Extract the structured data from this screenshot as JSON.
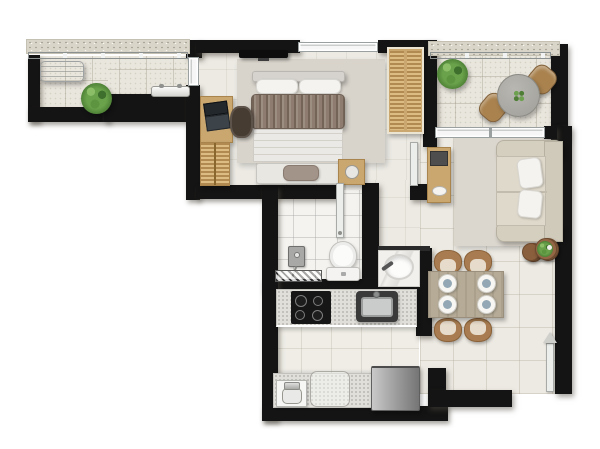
{
  "title": "Furnished one-bedroom apartment floor plan, top-down view, no text labels",
  "palette": {
    "wall": "#141414",
    "floor_tile": "#edeae3",
    "balcony_tile": "#e9e6dd",
    "bathroom_tile": "#f4f3ef",
    "wood": "#c9a76f",
    "dining_chair_wood": "#a87c50",
    "dining_table": "#b5ab97",
    "bed_duvet": "#8d7c6f",
    "rug": "#d8d4cc",
    "sofa": "#d5cfc0",
    "counter": "#e0dfda",
    "cooktop": "#141414",
    "fridge_steel": "#9e9e9e",
    "plant_green": "#5d9440",
    "railing_silver": "#aab0b0",
    "plate_center": "#93a7b4"
  },
  "rooms": [
    {
      "id": "balcony",
      "label": "balcony",
      "furniture": [
        "air-conditioner condenser unit",
        "potted plant",
        "drying rack / shelf"
      ]
    },
    {
      "id": "bedroom",
      "label": "bedroom",
      "furniture": [
        "wall-mounted TV",
        "double bed with taupe throw",
        "two pillows",
        "foot bench with cushion",
        "nightstand with lamp",
        "desk with laptop",
        "desk chair",
        "slatted drawer cabinet",
        "double wardrobe",
        "area rug"
      ]
    },
    {
      "id": "terrace",
      "label": "terrace",
      "furniture": [
        "potted shrub",
        "round bistro table with centerpiece plant",
        "two wooden chairs"
      ]
    },
    {
      "id": "living-room",
      "label": "living room",
      "furniture": [
        "wooden console sideboard with decor",
        "two-seat beige sofa",
        "two white throw pillows",
        "area rug",
        "potted plant"
      ]
    },
    {
      "id": "bathroom",
      "label": "bathroom",
      "furniture": [
        "shower control with hose",
        "glass shower screen",
        "toilet"
      ]
    },
    {
      "id": "vanity-niche",
      "label": "washbasin niche",
      "furniture": [
        "marble vanity counter with oval basin and faucet"
      ]
    },
    {
      "id": "kitchen",
      "label": "kitchen",
      "furniture": [
        "4-burner black cooktop",
        "stainless kitchen sink",
        "speckled counters",
        "laundry tub",
        "under-counter washer outline",
        "stainless refrigerator"
      ]
    },
    {
      "id": "dining-area",
      "label": "dining area",
      "furniture": [
        "wooden dining table",
        "four chairs",
        "four place settings",
        "potted plant"
      ]
    },
    {
      "id": "entry",
      "label": "entrance",
      "furniture": [
        "open entry door leaf",
        "entry direction arrow"
      ]
    }
  ],
  "doors": [
    "bathroom door (open)",
    "hall door to living room (open)",
    "entry door (open)"
  ],
  "windows": [
    "bedroom top window",
    "bedroom balcony window",
    "terrace glass sliding door",
    "balcony railing",
    "terrace railing"
  ]
}
